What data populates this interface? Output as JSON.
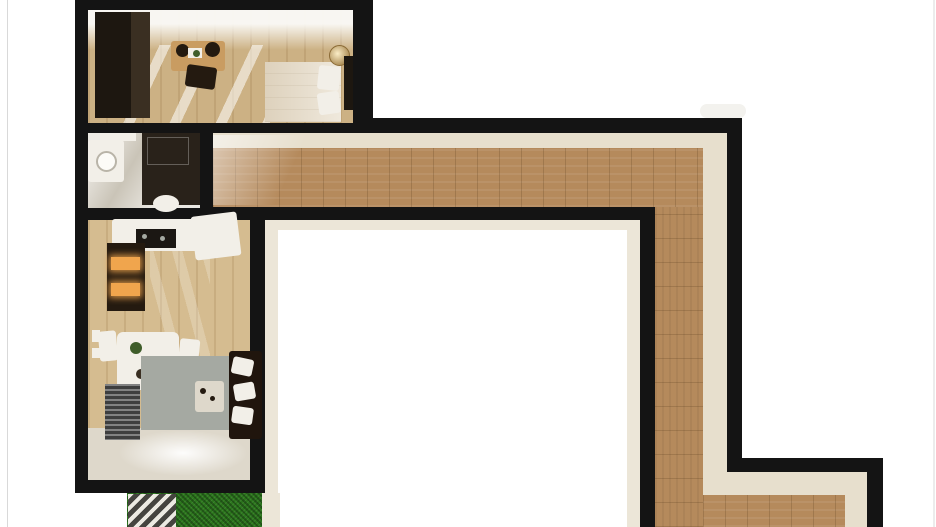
{
  "scene": {
    "type": "floor-plan-3d-render",
    "view": "top-down",
    "description": "Top-down 3D architectural render of a small apartment: bedroom with desk and bed, bathroom, kitchen-living room with dining table, sofa and rug, a long L-shaped wood corridor wrapping around an empty white core, and a grass balcony with striped doormat",
    "rooms": [
      {
        "name": "bedroom",
        "furniture": [
          "wardrobe",
          "desk",
          "desk-chair",
          "bed",
          "pillows",
          "gold-lamp",
          "wall-unit"
        ]
      },
      {
        "name": "bathroom",
        "furniture": [
          "sink-counter",
          "sink-bowl",
          "toilet",
          "shower"
        ]
      },
      {
        "name": "kitchen-living-room",
        "furniture": [
          "kitchen-counter",
          "cooktop",
          "fridge",
          "tall-cabinet",
          "dining-table",
          "chairs",
          "radiator",
          "rug",
          "coffee-table",
          "sofa",
          "sofa-pillows"
        ]
      },
      {
        "name": "hallway-corridor",
        "furniture": []
      },
      {
        "name": "balcony",
        "furniture": [
          "grass-lawn",
          "striped-doormat"
        ]
      }
    ],
    "palette": {
      "bg": "#ffffff",
      "wall": "#141414",
      "wood_corridor": "#b58a5c",
      "wood_room": "#ccb184",
      "wood_kitchen": "#d5bc90",
      "beige_face": "#e7dfcd",
      "beige_soft": "#ece6d8",
      "floor_south": "#ded8cb",
      "bath_tile": "#d6d0c4",
      "bath_dark": "#29221a",
      "white_surface": "#f2efe8",
      "wardrobe_dark": "#1d1710",
      "wardrobe_light": "#3a2f22",
      "desk_wood": "#c99c61",
      "dark_wood": "#241a10",
      "bed_cream": "#e9e0cf",
      "gold": "#b08d4f",
      "cooktop": "#1b1713",
      "glow": "#f0a54d",
      "rug": "#a5a9a2",
      "radiator": "#474747",
      "sofa_dark": "#20150d",
      "plant_green": "#3f5d2a",
      "grass": "#2b761c",
      "edge_line": "#d9d9d9",
      "edge_line_right": "#ececec",
      "shadow_soft": "#f3f2ee"
    }
  }
}
